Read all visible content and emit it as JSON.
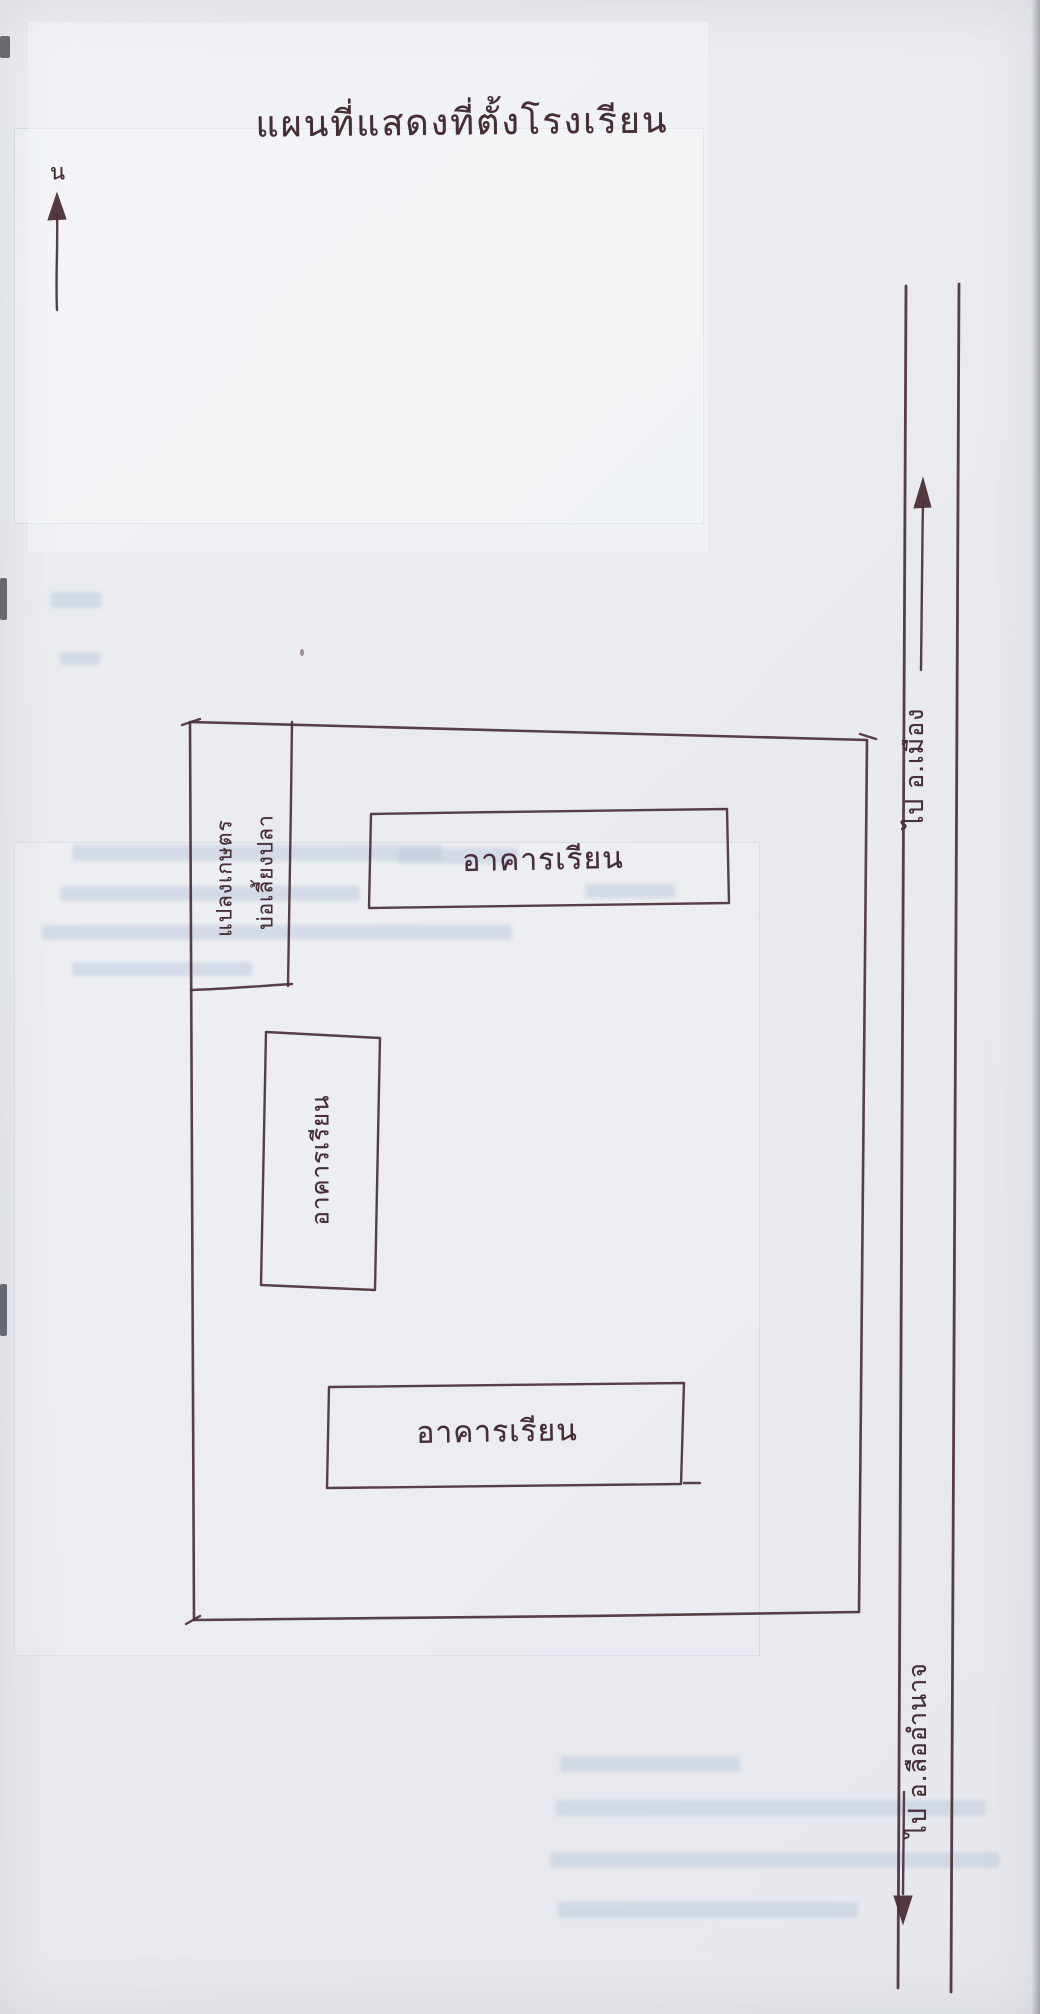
{
  "page": {
    "title": "แผนที่แสดงที่ตั้งโรงเรียน",
    "north_label": "น",
    "ink_color": "#4b2f37",
    "paper_color": "#e9ebef",
    "bleed_color": "#bfcbdd"
  },
  "map": {
    "buildings": [
      {
        "id": "upper-building",
        "label": "อาคารเรียน",
        "orientation": "horizontal"
      },
      {
        "id": "left-vertical-building",
        "label": "อาคารเรียน",
        "orientation": "vertical"
      },
      {
        "id": "lower-building",
        "label": "อาคารเรียน",
        "orientation": "horizontal"
      }
    ],
    "corner_box": {
      "line1": "แปลงเกษตร",
      "line2": "บ่อเลี้ยงปลา",
      "orientation": "vertical"
    },
    "road": {
      "label_top": "ไป อ.เมือง",
      "label_bottom": "ไป อ.ลืออำนาจ",
      "direction_top": "up-arrow",
      "direction_bottom": "down-arrow"
    }
  }
}
